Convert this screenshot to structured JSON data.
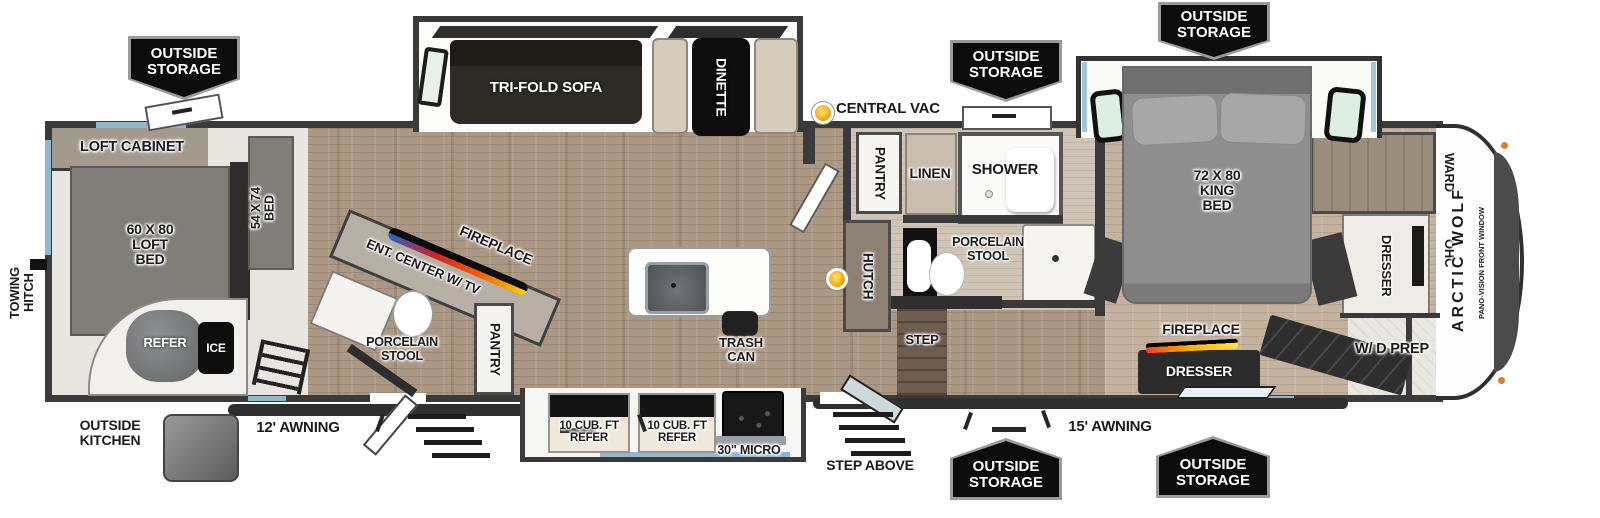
{
  "badges": {
    "outside_storage": "OUTSIDE\nSTORAGE"
  },
  "exterior": {
    "towing_hitch": "TOWING\nHITCH",
    "outside_kitchen": "OUTSIDE\nKITCHEN",
    "awning_12": "12' AWNING",
    "awning_15": "15' AWNING",
    "step_above": "STEP ABOVE"
  },
  "garage": {
    "loft_cabinet": "LOFT CABINET",
    "loft_bed": "60 X 80\nLOFT\nBED",
    "bed_54": "54 X 74\nBED",
    "refer": "REFER",
    "ice": "ICE"
  },
  "living": {
    "tri_fold_sofa": "TRI-FOLD SOFA",
    "dinette": "DINETTE",
    "central_vac": "CENTRAL VAC",
    "ent_center": "ENT. CENTER W/ TV",
    "fireplace": "FIREPLACE",
    "porcelain_stool": "PORCELAIN\nSTOOL",
    "pantry": "PANTRY",
    "trash_can": "TRASH\nCAN"
  },
  "kitchen": {
    "refer_left": "10 CUB. FT\nREFER",
    "refer_right": "10 CUB. FT\nREFER",
    "micro": "30\" MICRO"
  },
  "bath": {
    "pantry": "PANTRY",
    "hutch": "HUTCH",
    "linen": "LINEN",
    "shower": "SHOWER",
    "porcelain_stool": "PORCELAIN\nSTOOL",
    "step": "STEP"
  },
  "bedroom": {
    "king_bed": "72 X 80\nKING\nBED",
    "ward": "WARD",
    "ohc": "OHC",
    "dresser_side": "DRESSER",
    "fireplace": "FIREPLACE",
    "dresser": "DRESSER",
    "wd_prep": "W/ D PREP"
  },
  "front_cap": {
    "brand": "ARCTIC WOLF",
    "pano": "PANO-VISION FRONT WINDOW"
  },
  "colors": {
    "wall": "#3a3a3a",
    "wood_floor": "#ab9884",
    "accent_blue": "#8fb7cf",
    "badge_bg": "#0c0c0c",
    "indicator_orange": "#f0a010",
    "flame_gradient": "#ff3b1f,#ffb300,#ffe14d"
  }
}
